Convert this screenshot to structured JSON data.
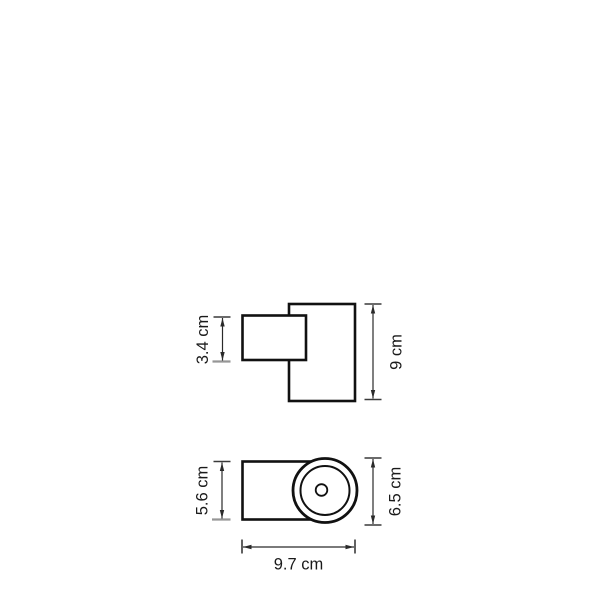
{
  "side_view": {
    "plate_height_label": "3.4 cm",
    "body_height_label": "9 cm"
  },
  "top_view": {
    "body_depth_label": "5.6 cm",
    "head_diameter_label": "6.5 cm",
    "overall_width_label": "9.7 cm"
  },
  "colors": {
    "outline": "#111111",
    "dimension_line": "#2a2a2a",
    "tick_dark": "#3a3a3a",
    "tick_gray": "#969696",
    "background": "#ffffff"
  }
}
